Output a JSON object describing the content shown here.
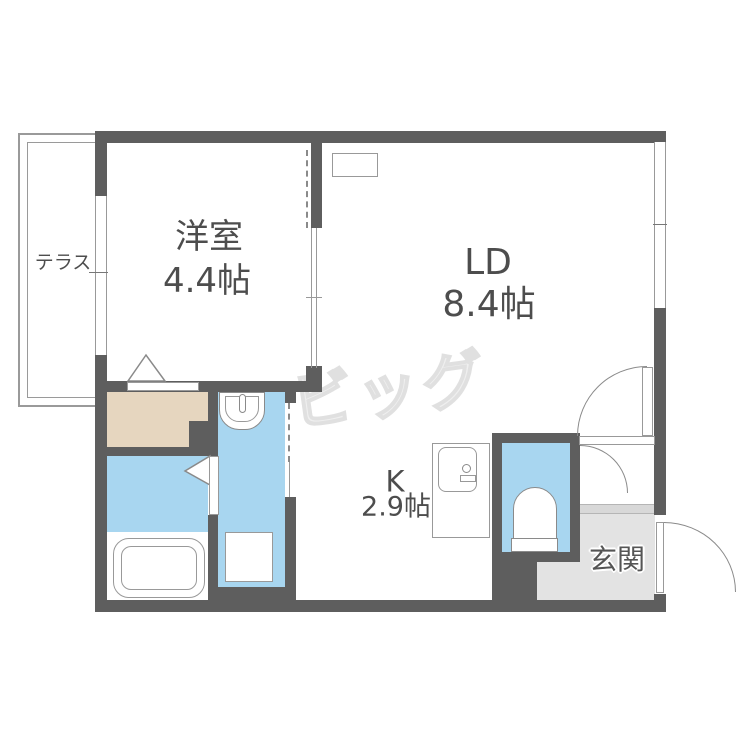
{
  "rooms": {
    "terrace": {
      "label": "テラス"
    },
    "western": {
      "label": "洋室",
      "size": "4.4帖"
    },
    "living_dining": {
      "label": "LD",
      "size": "8.4帖"
    },
    "kitchen": {
      "label": "K",
      "size": "2.9帖"
    },
    "entrance": {
      "label": "玄関"
    }
  },
  "watermark": "ビッグ",
  "colors": {
    "wall": "#5e5e5e",
    "wet_area_blue": "#a8d6f0",
    "closet_beige": "#e6d6bf",
    "entrance_floor_gray": "#e3e3e3",
    "fixture_line": "#8a8a8a",
    "label_text": "#4d4d4d",
    "watermark_gray": "#e0e0e0"
  },
  "fixtures": [
    "bathtub",
    "wash-basin",
    "toilet",
    "kitchen-sink",
    "washing-machine-pan"
  ]
}
